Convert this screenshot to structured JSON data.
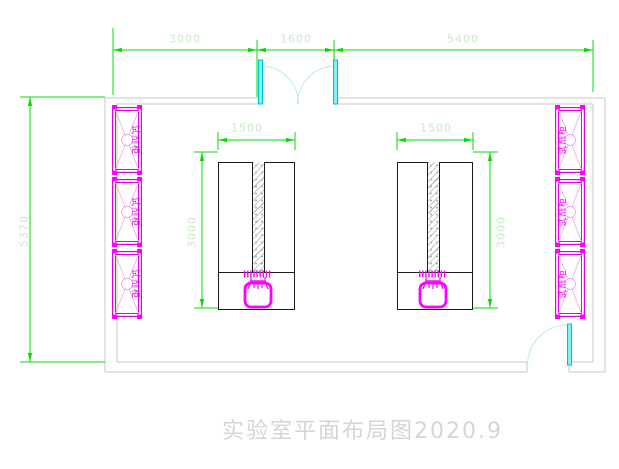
{
  "title": "实验室平面布局图2020.9",
  "dimensions": {
    "top_segments": [
      "3000",
      "1600",
      "5400"
    ],
    "room_height": "5370",
    "bench_width": "1500",
    "bench_depth": "3000"
  },
  "cabinets": {
    "label": "试剂柜",
    "left_count": 3,
    "right_count": 3
  },
  "colors": {
    "dimension_line": "#00dd00",
    "dimension_text": "#c8eac8",
    "wall": "#c8c8c8",
    "cabinet": "#ff00ff",
    "cabinet_detail": "#f2a2f2",
    "door_panel": "#7df4f4",
    "door_arc": "#b8ecec",
    "bench_outline": "#1c1c1c",
    "title_text": "#d5d5d5"
  }
}
